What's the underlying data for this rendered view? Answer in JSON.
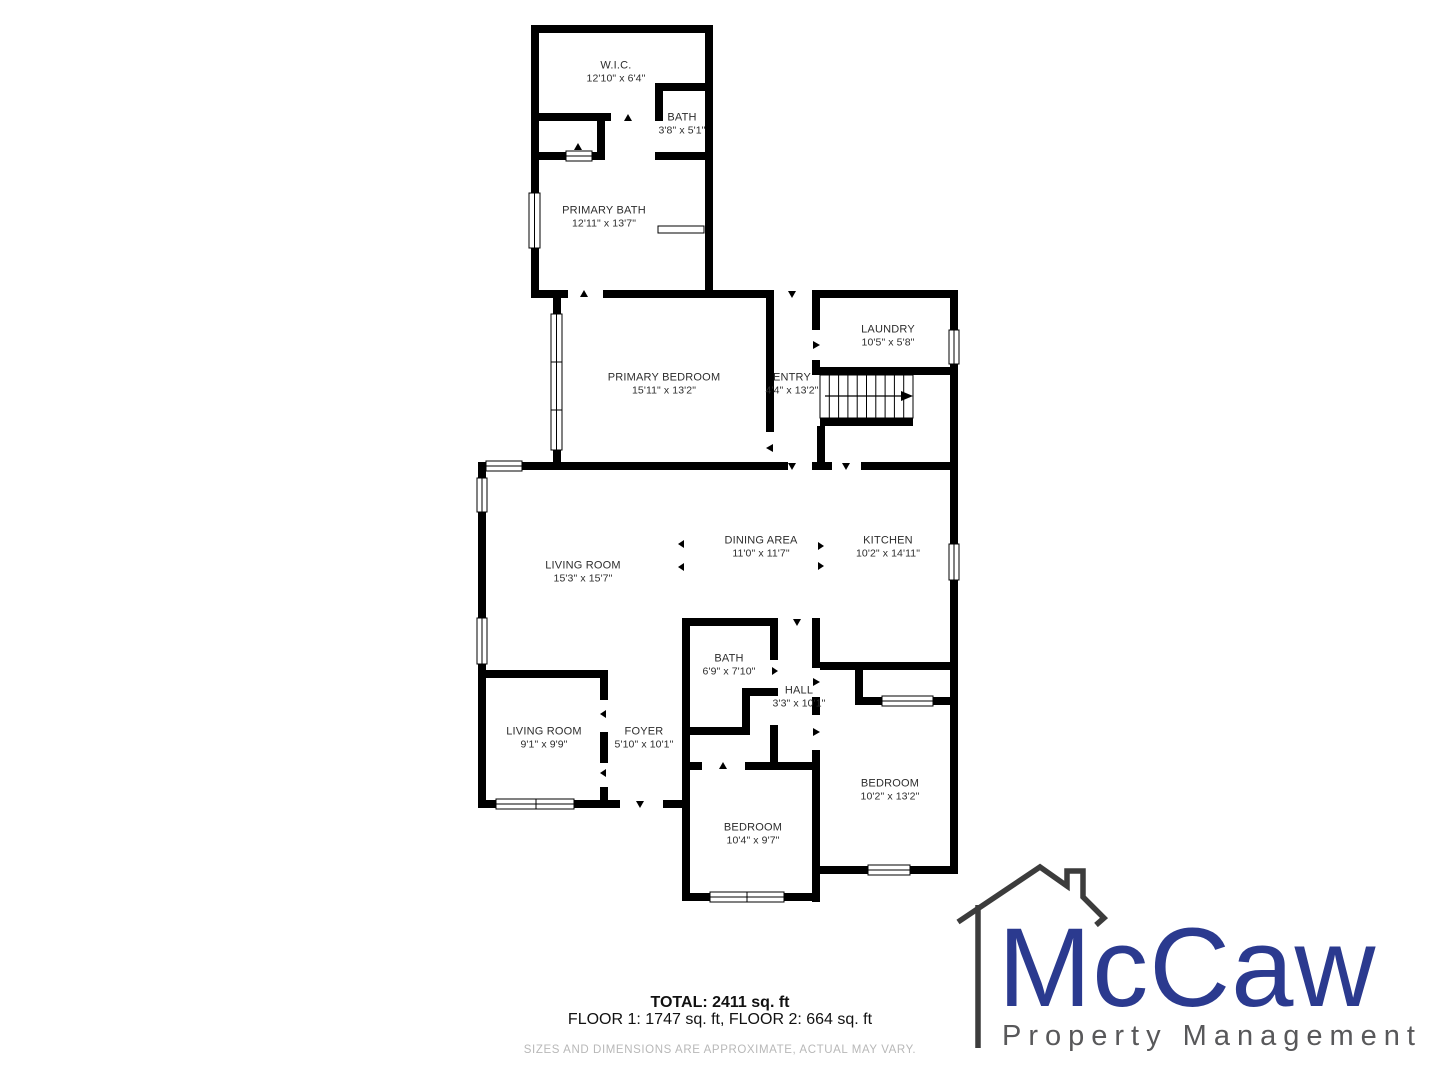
{
  "plan": {
    "wall_color": "#000000",
    "label_color": "#2d2d2d",
    "rooms": [
      {
        "id": "wic",
        "name": "W.I.C.",
        "dims": "12'10\" x 6'4\"",
        "x": 616,
        "y": 72
      },
      {
        "id": "bath-upper",
        "name": "BATH",
        "dims": "3'8\" x 5'1\"",
        "x": 682,
        "y": 124
      },
      {
        "id": "primary-bath",
        "name": "PRIMARY BATH",
        "dims": "12'11\" x 13'7\"",
        "x": 604,
        "y": 217
      },
      {
        "id": "primary-bedroom",
        "name": "PRIMARY BEDROOM",
        "dims": "15'11\" x 13'2\"",
        "x": 664,
        "y": 384
      },
      {
        "id": "entry",
        "name": "ENTRY",
        "dims": "4'4\" x 13'2\"",
        "x": 792,
        "y": 384
      },
      {
        "id": "laundry",
        "name": "LAUNDRY",
        "dims": "10'5\" x 5'8\"",
        "x": 888,
        "y": 336
      },
      {
        "id": "living-room",
        "name": "LIVING ROOM",
        "dims": "15'3\" x 15'7\"",
        "x": 583,
        "y": 572
      },
      {
        "id": "dining-area",
        "name": "DINING AREA",
        "dims": "11'0\" x 11'7\"",
        "x": 761,
        "y": 547
      },
      {
        "id": "kitchen",
        "name": "KITCHEN",
        "dims": "10'2\" x 14'11\"",
        "x": 888,
        "y": 547
      },
      {
        "id": "living-room-2",
        "name": "LIVING ROOM",
        "dims": "9'1\" x 9'9\"",
        "x": 544,
        "y": 738
      },
      {
        "id": "foyer",
        "name": "FOYER",
        "dims": "5'10\" x 10'1\"",
        "x": 644,
        "y": 738
      },
      {
        "id": "bath",
        "name": "BATH",
        "dims": "6'9\" x 7'10\"",
        "x": 729,
        "y": 665
      },
      {
        "id": "hall",
        "name": "HALL",
        "dims": "3'3\" x 10'1\"",
        "x": 799,
        "y": 697
      },
      {
        "id": "bedroom-right",
        "name": "BEDROOM",
        "dims": "10'2\" x 13'2\"",
        "x": 890,
        "y": 790
      },
      {
        "id": "bedroom-lower",
        "name": "BEDROOM",
        "dims": "10'4\" x 9'7\"",
        "x": 753,
        "y": 834
      }
    ],
    "stairs": {
      "treads": 10,
      "direction": "right"
    }
  },
  "footer": {
    "total": "TOTAL: 2411 sq. ft",
    "floors": "FLOOR 1: 1747 sq. ft, FLOOR 2: 664 sq. ft",
    "disclaimer": "SIZES AND DIMENSIONS ARE APPROXIMATE, ACTUAL MAY VARY."
  },
  "logo": {
    "brand": "McCaw",
    "tagline": "Property Management",
    "brand_color": "#2b3a8f",
    "tagline_color": "#58585a",
    "house_color": "#3c3c3c"
  }
}
